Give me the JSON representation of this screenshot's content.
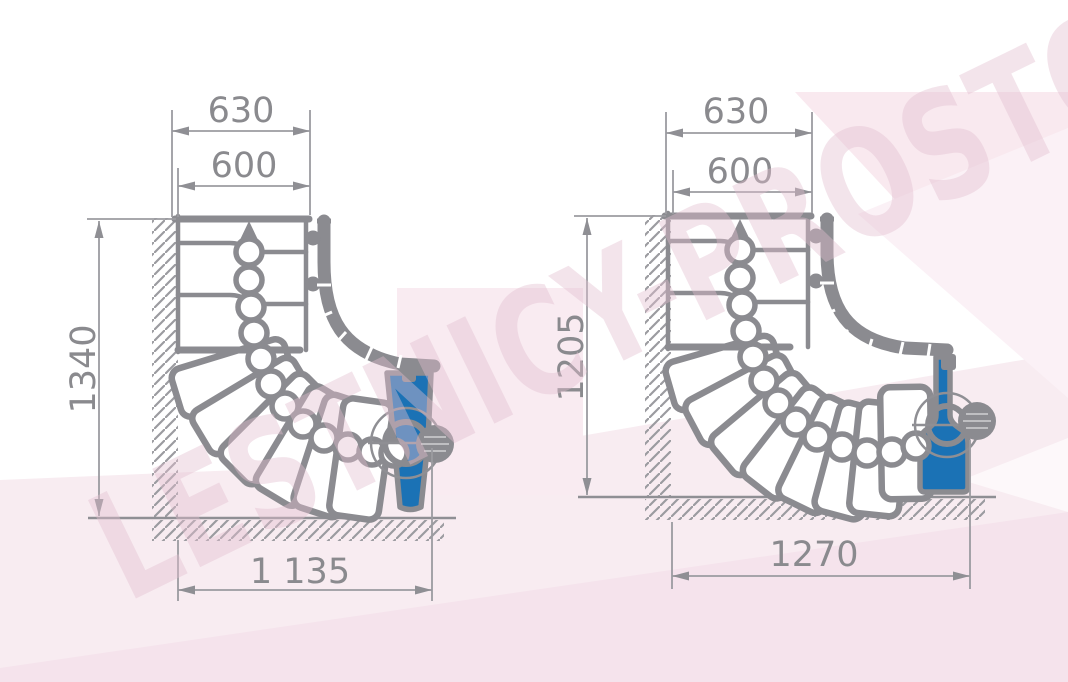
{
  "watermark": {
    "text": "LESTNICY-PROSTO.RU"
  },
  "colors": {
    "stair_gray": "#8b8b90",
    "dim_line_gray": "#9b9ba0",
    "text_gray": "#8a8a8e",
    "blue": "#1b72b5",
    "pink_bg": "#f8ecf1"
  },
  "drawings": {
    "left": {
      "dims": {
        "top_outer": "630",
        "top_inner": "600",
        "height": "1340",
        "width": "1 135"
      }
    },
    "right": {
      "dims": {
        "top_outer": "630",
        "top_inner": "600",
        "height": "1205",
        "width": "1270"
      }
    }
  }
}
